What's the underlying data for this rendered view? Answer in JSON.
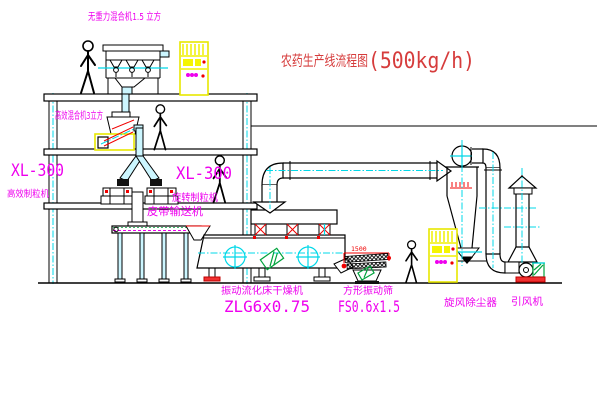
{
  "title": {
    "text": "农药生产线流程图",
    "capacity": "(500kg/h)"
  },
  "equipment": {
    "gravity_free_mixer": "无重力混合机1.5 立方",
    "high_efficiency_mixer": "高效混合机3立方",
    "granulator_left_model": "XL-300",
    "granulator_left": "高效制粒机",
    "granulator_mid_model": "XL-300",
    "granulator_mid": "旋转制粒机",
    "belt_conveyor": "皮带输送机",
    "fluid_bed_dryer": "振动流化床干燥机",
    "fluid_bed_dryer_model": "ZLG6x0.75",
    "square_sieve": "方形振动筛",
    "square_sieve_model": "FS0.6x1.5",
    "cyclone": "旋风除尘器",
    "induced_draft_fan": "引风机"
  },
  "dimensions": {
    "sieve_width": "1500"
  },
  "colors": {
    "label_magenta": "#ee00ee",
    "title_red": "#d63c3c",
    "pipe_cyan": "#00d8e8",
    "cabinet_yellow": "#f5f500",
    "alert_red": "#f00000",
    "motor_green": "#00a33c",
    "line_black": "#000000"
  }
}
